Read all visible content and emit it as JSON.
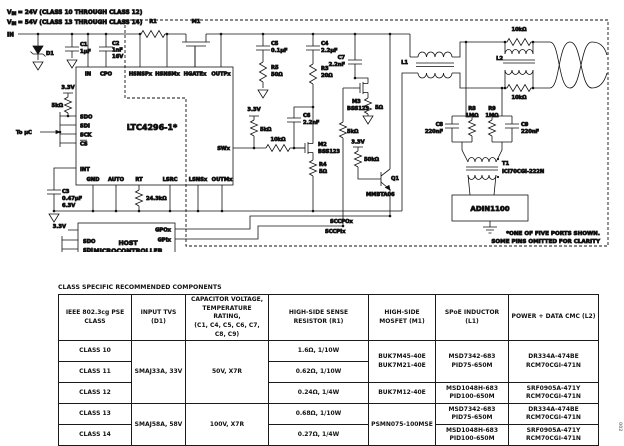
{
  "schematic": {
    "vin1": {
      "v": "V",
      "sub": "IN",
      "rest": "= 24V (CLASS 10 THROUGH CLASS 12)"
    },
    "vin2": {
      "v": "V",
      "sub": "IN",
      "rest": "= 54V (CLASS 13 THROUGH CLASS 14)"
    },
    "in_label": "IN",
    "supply_3v3": "3.3V",
    "to_uc": "To µC",
    "ic": {
      "name": "LTC4296-1*",
      "pins": {
        "in": "IN",
        "cpo": "CPO",
        "hsnspx": "HSNSPx",
        "hsnsmx": "HSNSMx",
        "hgatex": "HGATEx",
        "outpx": "OUTPx",
        "sdo": "SDO",
        "sdi": "SDI",
        "sck": "SCK",
        "cs": "CS",
        "int": "INT",
        "gnd": "GND",
        "auto": "AUTO",
        "rt": "RT",
        "lsrc": "LSRC",
        "lsnsx": "LSNSx",
        "outmx": "OUTMx",
        "swx": "SWx"
      }
    },
    "host": {
      "line1": "HOST",
      "line2": "MICROCONTROLLER",
      "supply": "3.3V",
      "spi_bus": "SPI BUS",
      "pins": {
        "sdo": "SDO",
        "sdi": "SDI",
        "clk": "CLK",
        "cs": "CS",
        "gpox": "GPOx",
        "gpix": "GPIx"
      }
    },
    "phy": "ADIN1100",
    "components": {
      "d1": "D1",
      "c1": "C1",
      "c1_val": "1µF",
      "c2": "C2",
      "c2_val": "1nF",
      "c2_v": "16V",
      "c3": "C3",
      "c3_val": "0.47µF",
      "c3_v": "6.3V",
      "r1": "R1",
      "m1": "M1",
      "spi_pullup": "5kΩ",
      "rt_val": "24.3kΩ",
      "c5": "C5",
      "c5_val": "0.1µF",
      "r5": "R5",
      "r5_val": "50Ω",
      "c4": "C4",
      "c4_val": "2.2µF",
      "r3": "R3",
      "r3_val": "20Ω",
      "c6": "C6",
      "c6_val": "2.2nF",
      "sw_pull": "5kΩ",
      "sw_series": "10kΩ",
      "m2": "M2",
      "m2_part": "BSS123",
      "r4": "R4",
      "r4_val": "5Ω",
      "c7": "C7",
      "c7_val": "2.2nF",
      "m3": "M3",
      "m3_part": "BSS123",
      "m3_src": "5Ω",
      "m3_pull": "5kΩ",
      "q1": "Q1",
      "q1_part": "MMBTA06",
      "q1_base": "50kΩ",
      "l1": "L1",
      "l2": "L2",
      "l2_rtop": "10kΩ",
      "l2_rbot": "10kΩ",
      "r8": "R8",
      "r8_val": "1MΩ",
      "r9": "R9",
      "r9_val": "1MΩ",
      "c8": "C8",
      "c8_val": "220nF",
      "c9": "C9",
      "c9_val": "220nF",
      "t1": "T1",
      "t1_part": "ICI70CGI-222N"
    },
    "signals": {
      "sccpox": "SCCPOx",
      "sccpix": "SCCPIx"
    },
    "note1": "*ONE OF FIVE PORTS SHOWN.",
    "note2": "SOME PINS OMITTED FOR CLARITY",
    "fig_id": "002"
  },
  "table": {
    "title": "CLASS SPECIFIC RECOMMENDED COMPONENTS",
    "headers": {
      "class": "IEEE 802.3cg PSE CLASS",
      "tvs": "INPUT TVS (D1)",
      "cap1": "CAPACITOR VOLTAGE,",
      "cap2": "TEMPERATURE RATING,",
      "cap3": "(C1, C4, C5, C6, C7, C8, C9)",
      "r1a": "HIGH-SIDE SENSE",
      "r1b": "RESISTOR (R1)",
      "m1a": "HIGH-SIDE",
      "m1b": "MOSFET (M1)",
      "l1": "SPoE INDUCTOR (L1)",
      "l2": "POWER + DATA CMC (L2)"
    },
    "classes": {
      "c10": "CLASS 10",
      "c11": "CLASS 11",
      "c12": "CLASS 12",
      "c13": "CLASS 13",
      "c14": "CLASS 14"
    },
    "tvs": {
      "g1": "SMAJ33A, 33V",
      "g2": "SMAJ58A, 58V"
    },
    "cap": {
      "g1": "50V, X7R",
      "g2": "100V, X7R"
    },
    "r1": {
      "c10": "1.6Ω, 1/10W",
      "c11": "0.62Ω, 1/10W",
      "c12": "0.24Ω, 1/4W",
      "c13": "0.68Ω, 1/10W",
      "c14": "0.27Ω, 1/4W"
    },
    "m1": {
      "g1a": "BUK7M45-40E",
      "g1b": "BUK7M21-40E",
      "c12": "BUK7M12-40E",
      "g2": "PSMN075-100MSE"
    },
    "l1": {
      "a1": "MSD7342-683",
      "a2": "PID75-650M",
      "b1": "MSD1048H-683",
      "b2": "PID100-650M"
    },
    "l2": {
      "a1": "DR334A-474BE",
      "a2": "RCM70CGI-471N",
      "b1": "SRF0905A-471Y",
      "b2": "RCM70CGI-471N"
    }
  }
}
